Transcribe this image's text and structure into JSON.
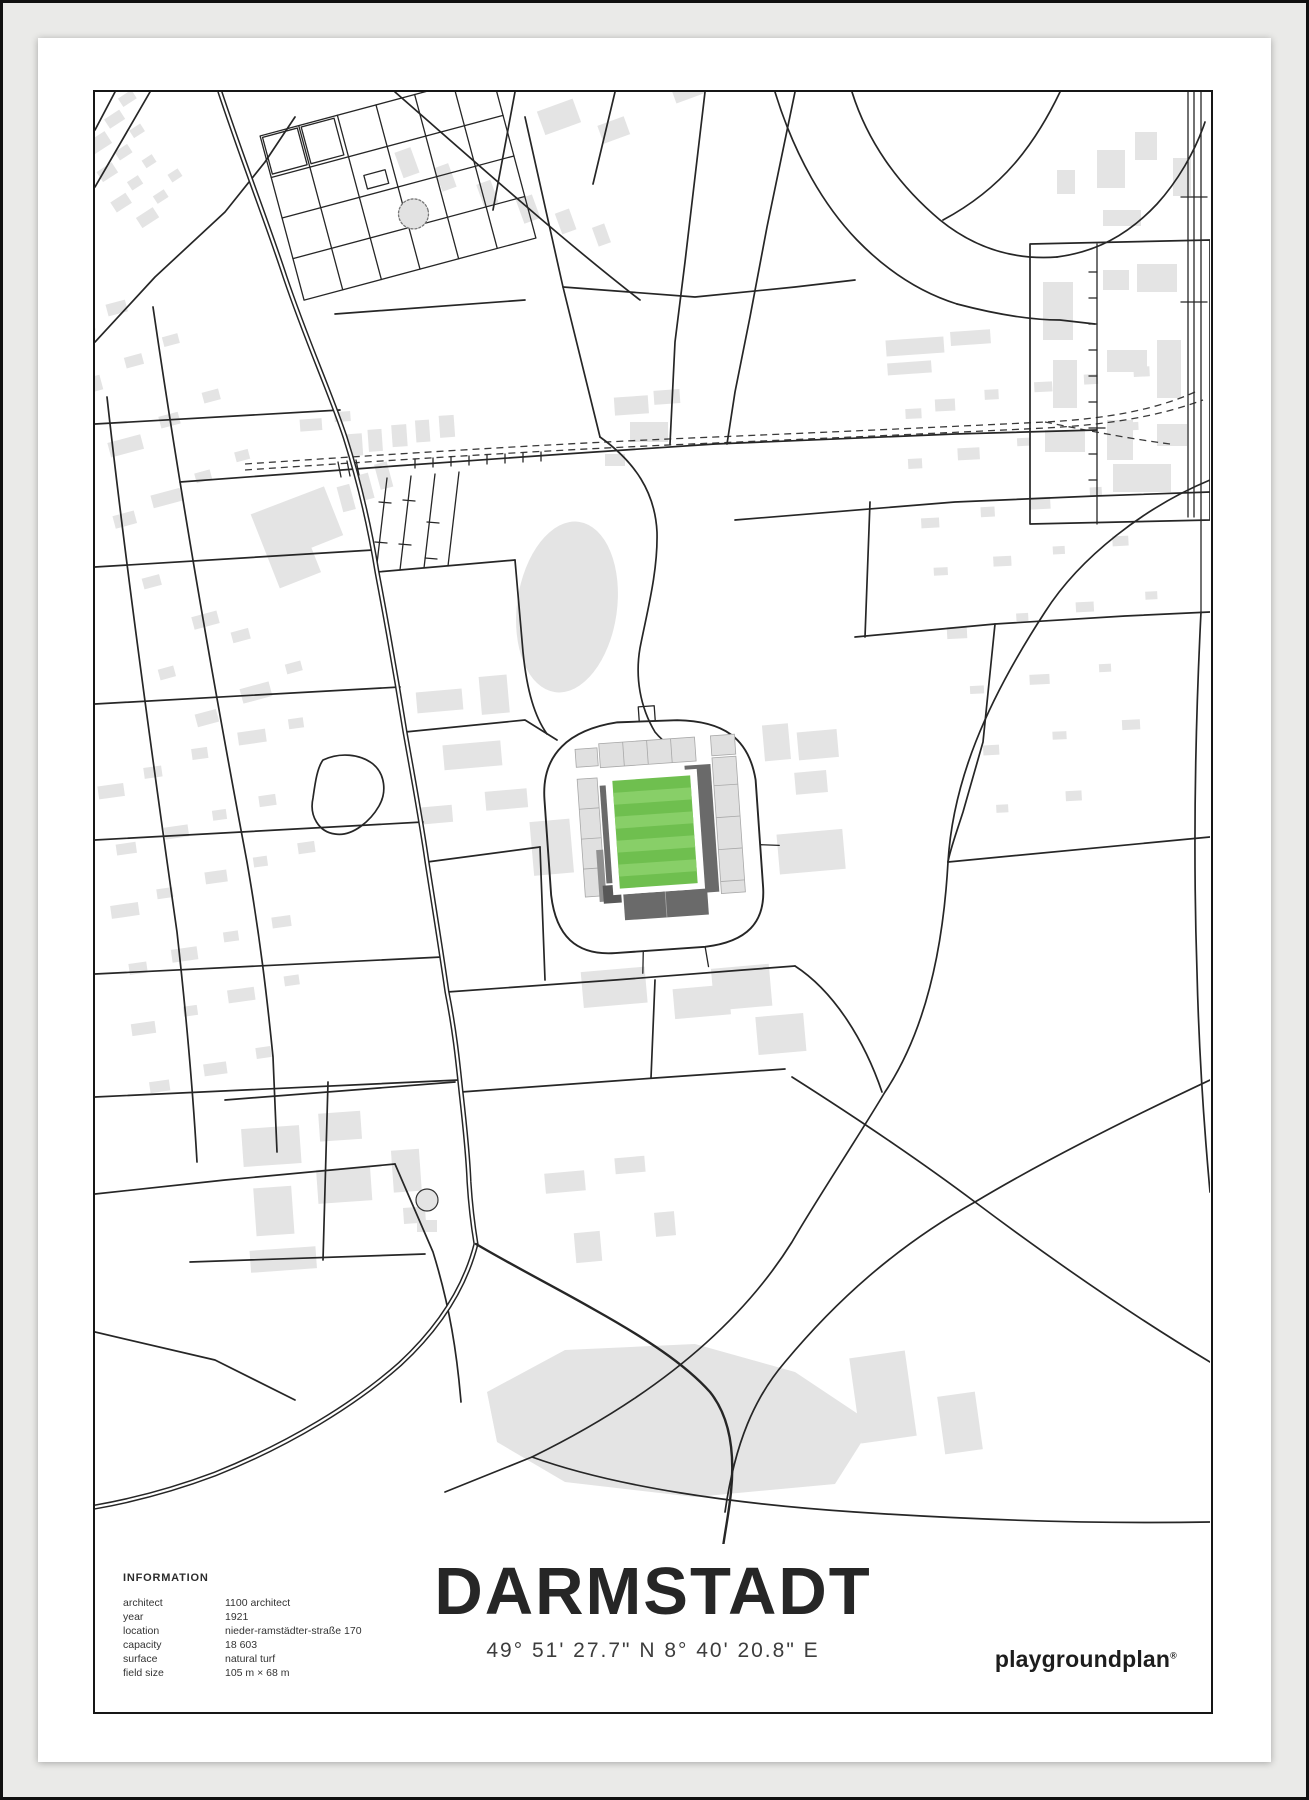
{
  "poster": {
    "title": "DARMSTADT",
    "coordinates": "49° 51' 27.7\" N  8° 40' 20.8\" E",
    "brand": "playgroundplan",
    "brand_mark": "®",
    "info": {
      "heading": "INFORMATION",
      "rows": [
        {
          "label": "architect",
          "value": "1100 architect"
        },
        {
          "label": "year",
          "value": "1921"
        },
        {
          "label": "location",
          "value": "nieder-ramstädter-straße 170"
        },
        {
          "label": "capacity",
          "value": "18 603"
        },
        {
          "label": "surface",
          "value": "natural turf"
        },
        {
          "label": "field size",
          "value": "105 m × 68 m"
        }
      ]
    }
  },
  "map": {
    "landmark": "stadium",
    "colors": {
      "pitch_green": "#6fbf4f",
      "pitch_stripe": "#88cf68",
      "building_gray": "#e4e4e4",
      "stand_dark": "#6a6a6a",
      "stand_light": "#e0e0e0",
      "road": "#262626",
      "mat": "#eaeae8"
    }
  }
}
